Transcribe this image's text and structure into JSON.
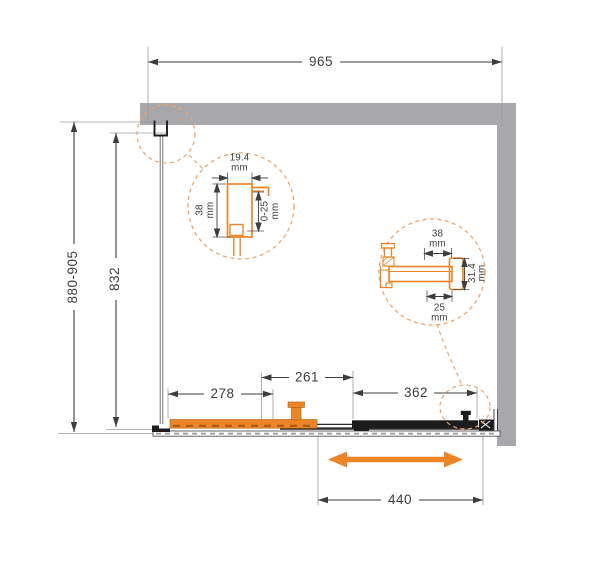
{
  "colors": {
    "accent_orange": "#ED8527",
    "callout_dash_orange": "#F0A469",
    "wall_gray": "#A8A8AC",
    "dimension_line": "#3D3D3D",
    "panel_black": "#1C1C1C"
  },
  "dimensions": {
    "top_width": "965",
    "side_height_range": "880-905",
    "glass_height": "832",
    "fixed_panel_width": "278",
    "overlap_width": "261",
    "door_panel_width": "362",
    "slide_opening_width": "440"
  },
  "detail_wall_profile": {
    "width_value": "19.4",
    "width_unit": "mm",
    "depth_value": "38",
    "depth_unit": "mm",
    "adjustment_value": "0-25",
    "adjustment_unit": "mm"
  },
  "detail_door_profile": {
    "top_value": "38",
    "top_unit": "mm",
    "side_value": "31.4",
    "side_unit": "mm",
    "bottom_value": "25",
    "bottom_unit": "mm"
  }
}
